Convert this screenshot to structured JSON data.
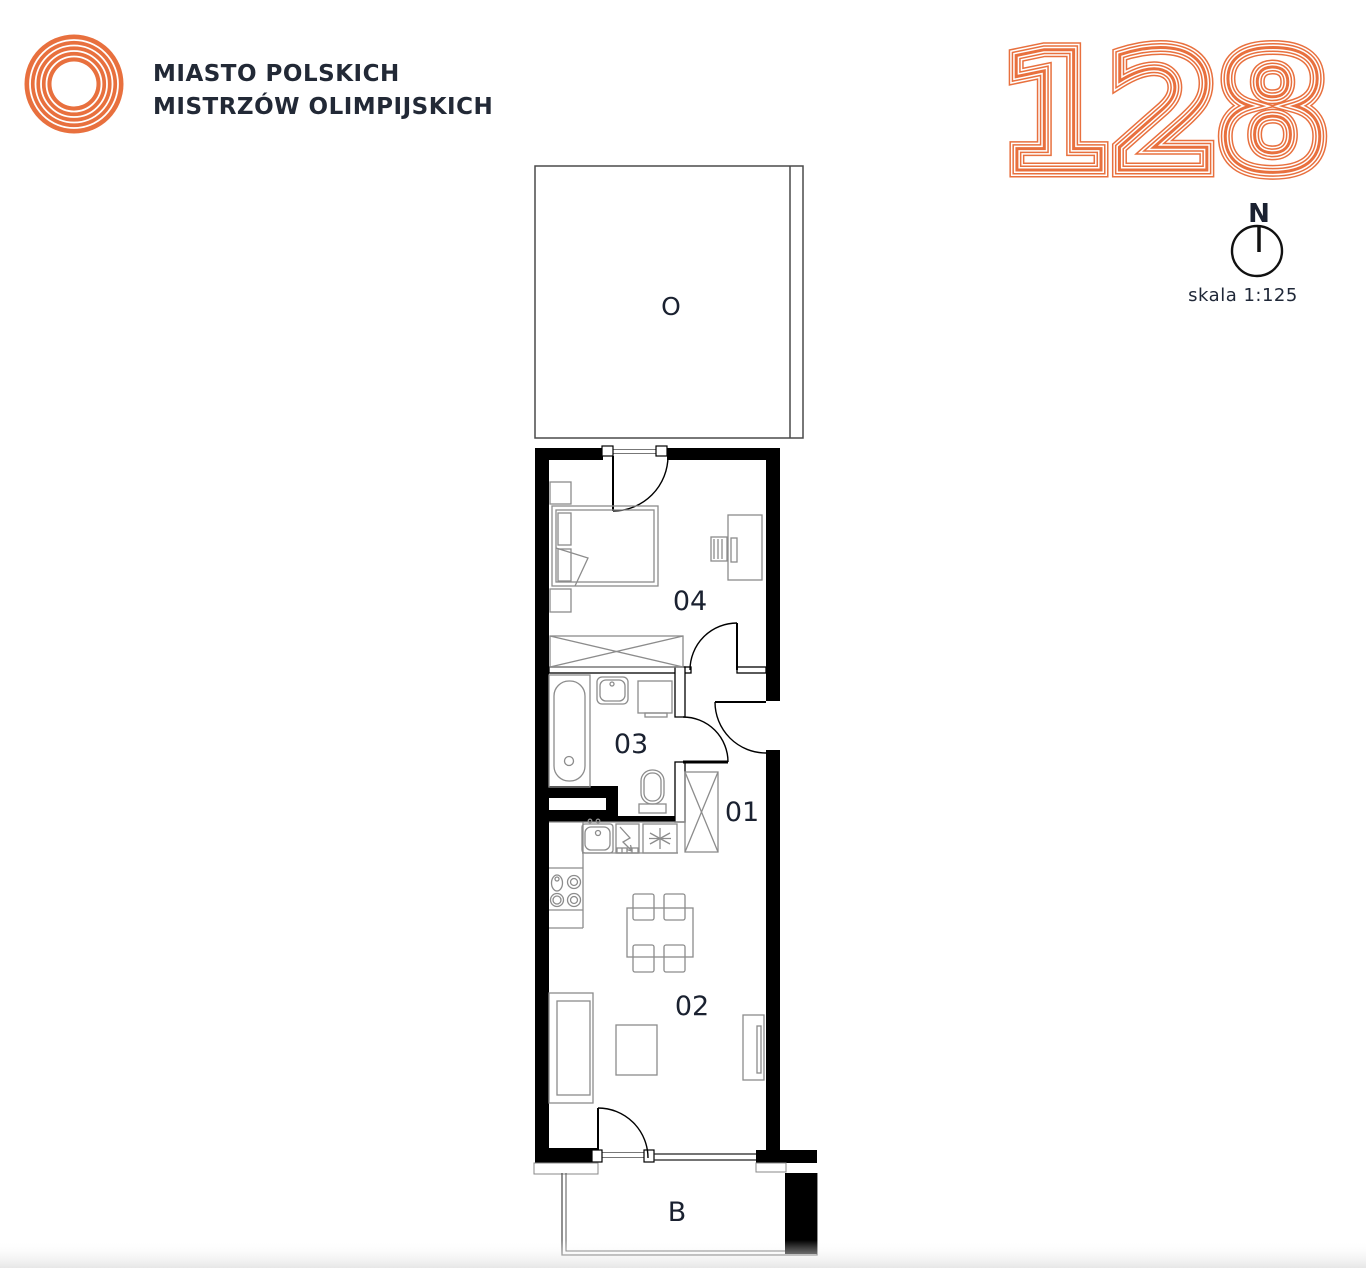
{
  "brand": {
    "line1": "MIASTO POLSKICH",
    "line2": "MISTRZÓW OLIMPIJSKICH",
    "logo_color": "#e8703e",
    "text_color": "#222936"
  },
  "unit": {
    "number": "128",
    "accent_color": "#e8703e"
  },
  "compass": {
    "north_label": "N"
  },
  "scale_label": "skala 1:125",
  "plan": {
    "rooms": [
      {
        "id": "01",
        "label": "01"
      },
      {
        "id": "02",
        "label": "02"
      },
      {
        "id": "03",
        "label": "03"
      },
      {
        "id": "04",
        "label": "04"
      }
    ],
    "terrace_label": "O",
    "balcony_label": "B",
    "wall_color": "#000000",
    "partition_color": "#ffffff",
    "furniture_line_color": "#8c8c8c",
    "label_color": "#1a2130"
  }
}
